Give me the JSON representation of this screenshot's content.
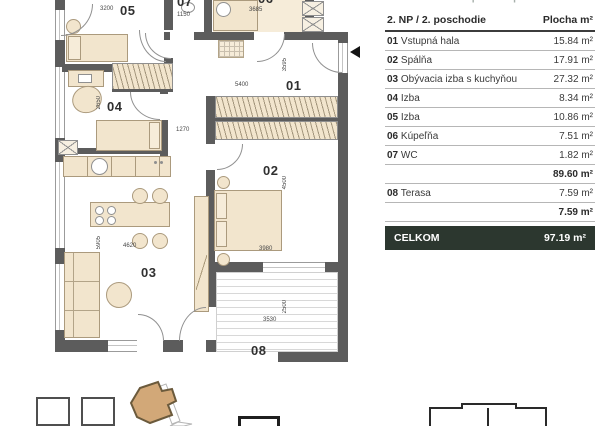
{
  "header": {
    "clipped_title": "4-IZBOVÝ BYT | 2. NP | ČÍSLO BYTU 2.05"
  },
  "table": {
    "floor_label": "2. NP / 2. poschodie",
    "area_label": "Plocha m²",
    "rows": [
      {
        "num": "01",
        "name": "Vstupná hala",
        "area": "15.84 m²"
      },
      {
        "num": "02",
        "name": "Spálňa",
        "area": "17.91 m²"
      },
      {
        "num": "03",
        "name": "Obývacia izba s kuchyňou",
        "area": "27.32 m²"
      },
      {
        "num": "04",
        "name": "Izba",
        "area": "8.34 m²"
      },
      {
        "num": "05",
        "name": "Izba",
        "area": "10.86 m²"
      },
      {
        "num": "06",
        "name": "Kúpeľňa",
        "area": "7.51 m²"
      },
      {
        "num": "07",
        "name": "WC",
        "area": "1.82 m²"
      }
    ],
    "interior_subtotal": "89.60 m²",
    "terrace_row": {
      "num": "08",
      "name": "Terasa",
      "area": "7.59 m²"
    },
    "terrace_subtotal": "7.59 m²",
    "total_label": "CELKOM",
    "total_value": "97.19 m²"
  },
  "plan": {
    "rooms": {
      "r01": "01",
      "r02": "02",
      "r03": "03",
      "r04": "04",
      "r05": "05",
      "r06": "06",
      "r07": "07",
      "r08": "08"
    },
    "dims": {
      "d3200": "3200",
      "d1150": "1150",
      "d3685": "3685",
      "d5400": "5400",
      "d3595": "3595",
      "d2650": "2650",
      "d1270": "1270",
      "d4500": "4500",
      "d3980": "3980",
      "d5905": "5905",
      "d4620": "4620",
      "d3530": "3530",
      "d2500": "2500"
    }
  },
  "colors": {
    "wall": "#5c5c5c",
    "furniture": "#f2e5cd",
    "total_row_bg": "#2c372f",
    "site_building": "#d2a878"
  }
}
